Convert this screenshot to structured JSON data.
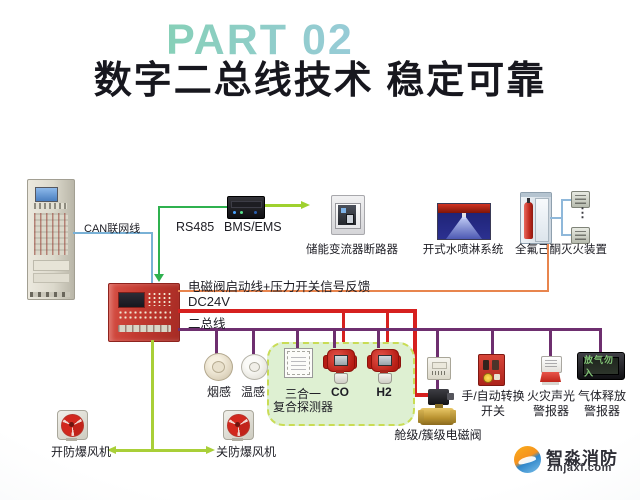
{
  "header": {
    "part": "PART 02",
    "title": "数字二总线技术 稳定可靠"
  },
  "lines": {
    "can": "CAN联网线",
    "rs485": "RS485",
    "bms_ems": "BMS/EMS",
    "solenoid_feedback": "电磁阀启动线+压力开关信号反馈",
    "dc24v": "DC24V",
    "two_bus": "二总线"
  },
  "devices": {
    "breaker": "储能变流器断路器",
    "water_spray": "开式水喷淋系统",
    "ffh": "全氟己酮灭火装置",
    "ffh_more": "⋮",
    "smoke": "烟感",
    "heat": "温感",
    "combo_line1": "三合一",
    "combo_line2": "复合探测器",
    "co": "CO",
    "h2": "H2",
    "valve": "舱级/簇级电磁阀",
    "switch_line1": "手/自动转换",
    "switch_line2": "开关",
    "sounder_line1": "火灾声光",
    "sounder_line2": "警报器",
    "gas_release_line1": "气体释放",
    "gas_release_line2": "警报器",
    "gas_sign": "放气勿入",
    "fan_open": "开防爆风机",
    "fan_close": "关防爆风机"
  },
  "branding": {
    "name": "智淼消防",
    "site": "zmjaxf.com"
  },
  "colors": {
    "part_gradient_from": "#7fd2a9",
    "part_gradient_to": "#9fc9e6",
    "title": "#17171e",
    "can_line": "#79b1d6",
    "rs485_line": "#2fb14f",
    "bms_arrow": "#9fd12f",
    "feedback_line": "#e8854e",
    "dc24v_line": "#d6201f",
    "two_bus_line": "#6e2f6f",
    "fan_line": "#a9cf38",
    "panel_red": "#c23a30",
    "green_zone": "#def0d2"
  }
}
